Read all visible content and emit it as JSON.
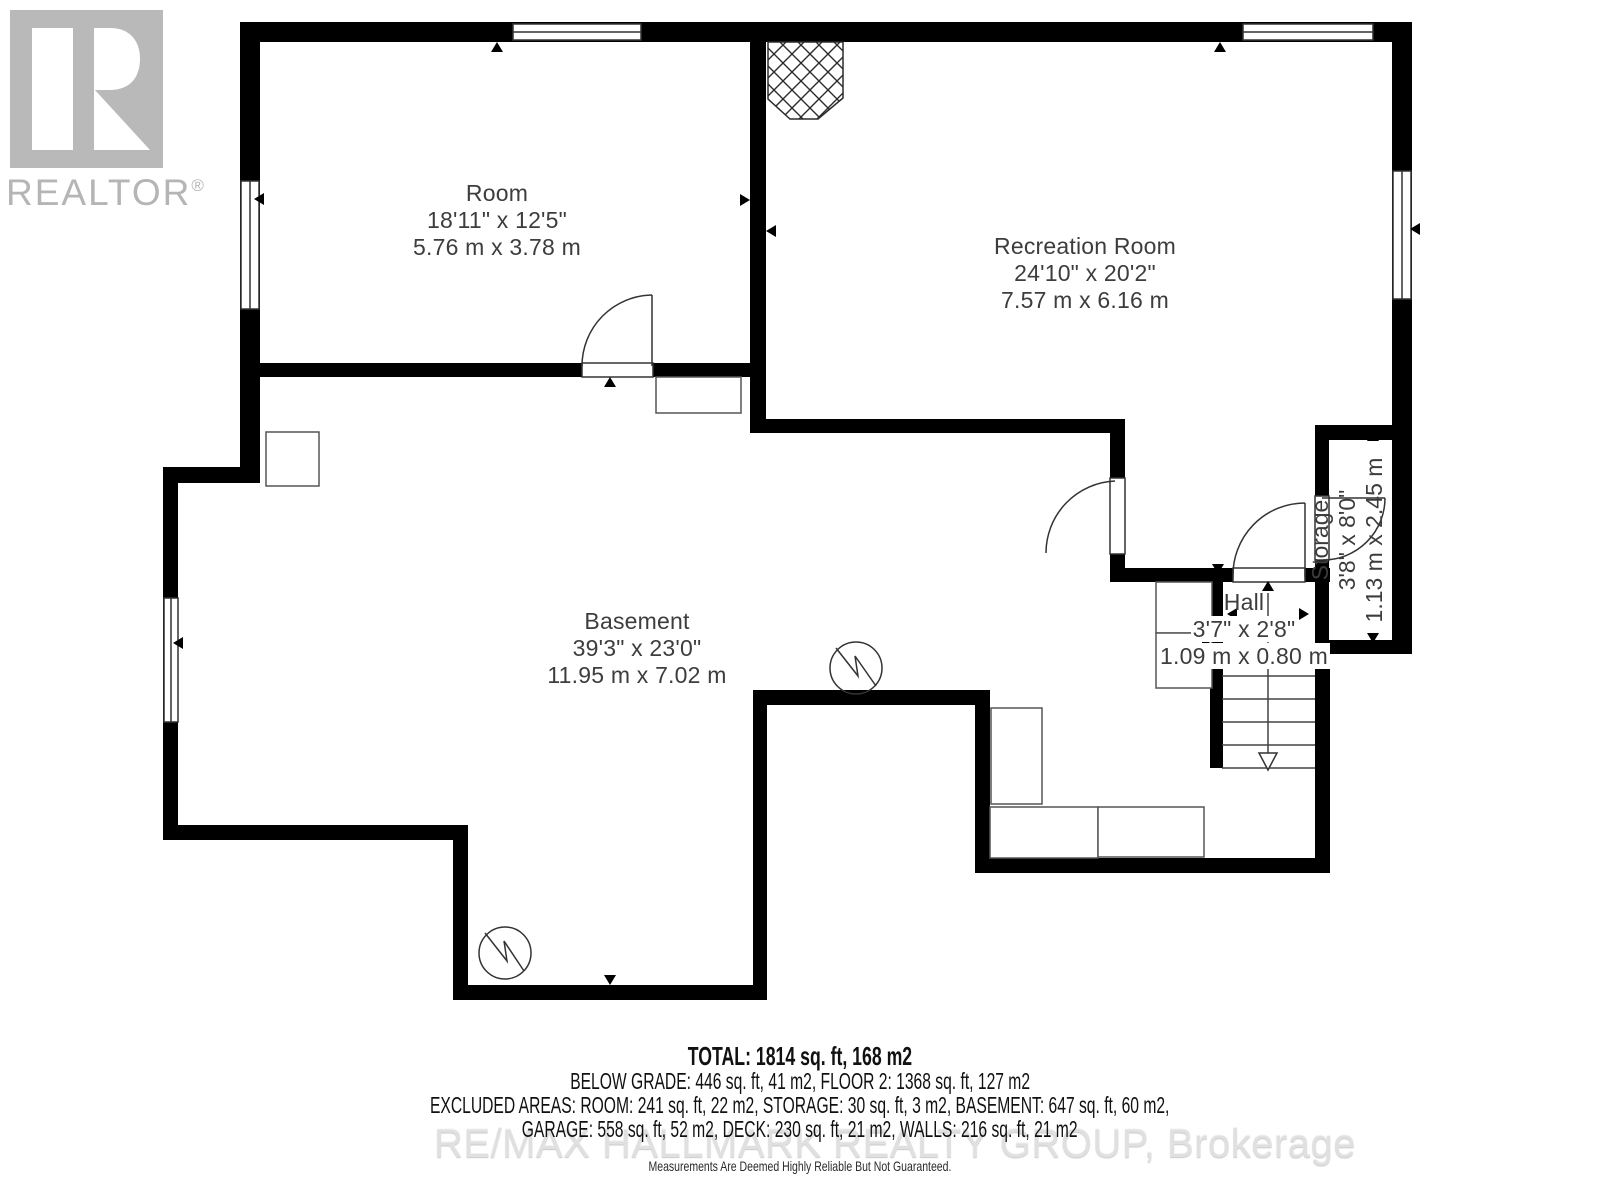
{
  "branding": {
    "logo_text": "REALTOR",
    "logo_reg": "®"
  },
  "rooms": [
    {
      "name": "Room",
      "imperial": "18'11\" x 12'5\"",
      "metric": "5.76 m x 3.78 m"
    },
    {
      "name": "Recreation Room",
      "imperial": "24'10\" x 20'2\"",
      "metric": "7.57 m x 6.16 m"
    },
    {
      "name": "Basement",
      "imperial": "39'3\" x 23'0\"",
      "metric": "11.95 m x 7.02 m"
    },
    {
      "name": "Hall",
      "imperial": "3'7\" x 2'8\"",
      "metric": "1.09 m x 0.80 m"
    },
    {
      "name": "Storage",
      "imperial": "3'8\" x 8'0\"",
      "metric": "1.13 m x 2.45 m"
    }
  ],
  "summary": {
    "total": "TOTAL: 1814 sq. ft, 168 m2",
    "below_grade": "BELOW GRADE: 446 sq. ft, 41 m2, FLOOR 2: 1368 sq. ft, 127 m2",
    "excluded": "EXCLUDED AREAS: ROOM: 241 sq. ft, 22 m2, STORAGE: 30 sq. ft, 3 m2, BASEMENT: 647 sq. ft, 60 m2,",
    "excluded2": "GARAGE: 558 sq. ft, 52 m2, DECK: 230 sq. ft, 21 m2, WALLS: 216 sq. ft, 21 m2"
  },
  "watermark": "RE/MAX HALLMARK REALTY GROUP, Brokerage",
  "disclaimer": "Measurements Are Deemed Highly Reliable But Not Guaranteed.",
  "colors": {
    "wall": "#000000",
    "thin_line": "#444444",
    "label": "#3d3d3d",
    "logo_gray": "#b9b9b9",
    "watermark_gray": "#e0e0e0"
  }
}
